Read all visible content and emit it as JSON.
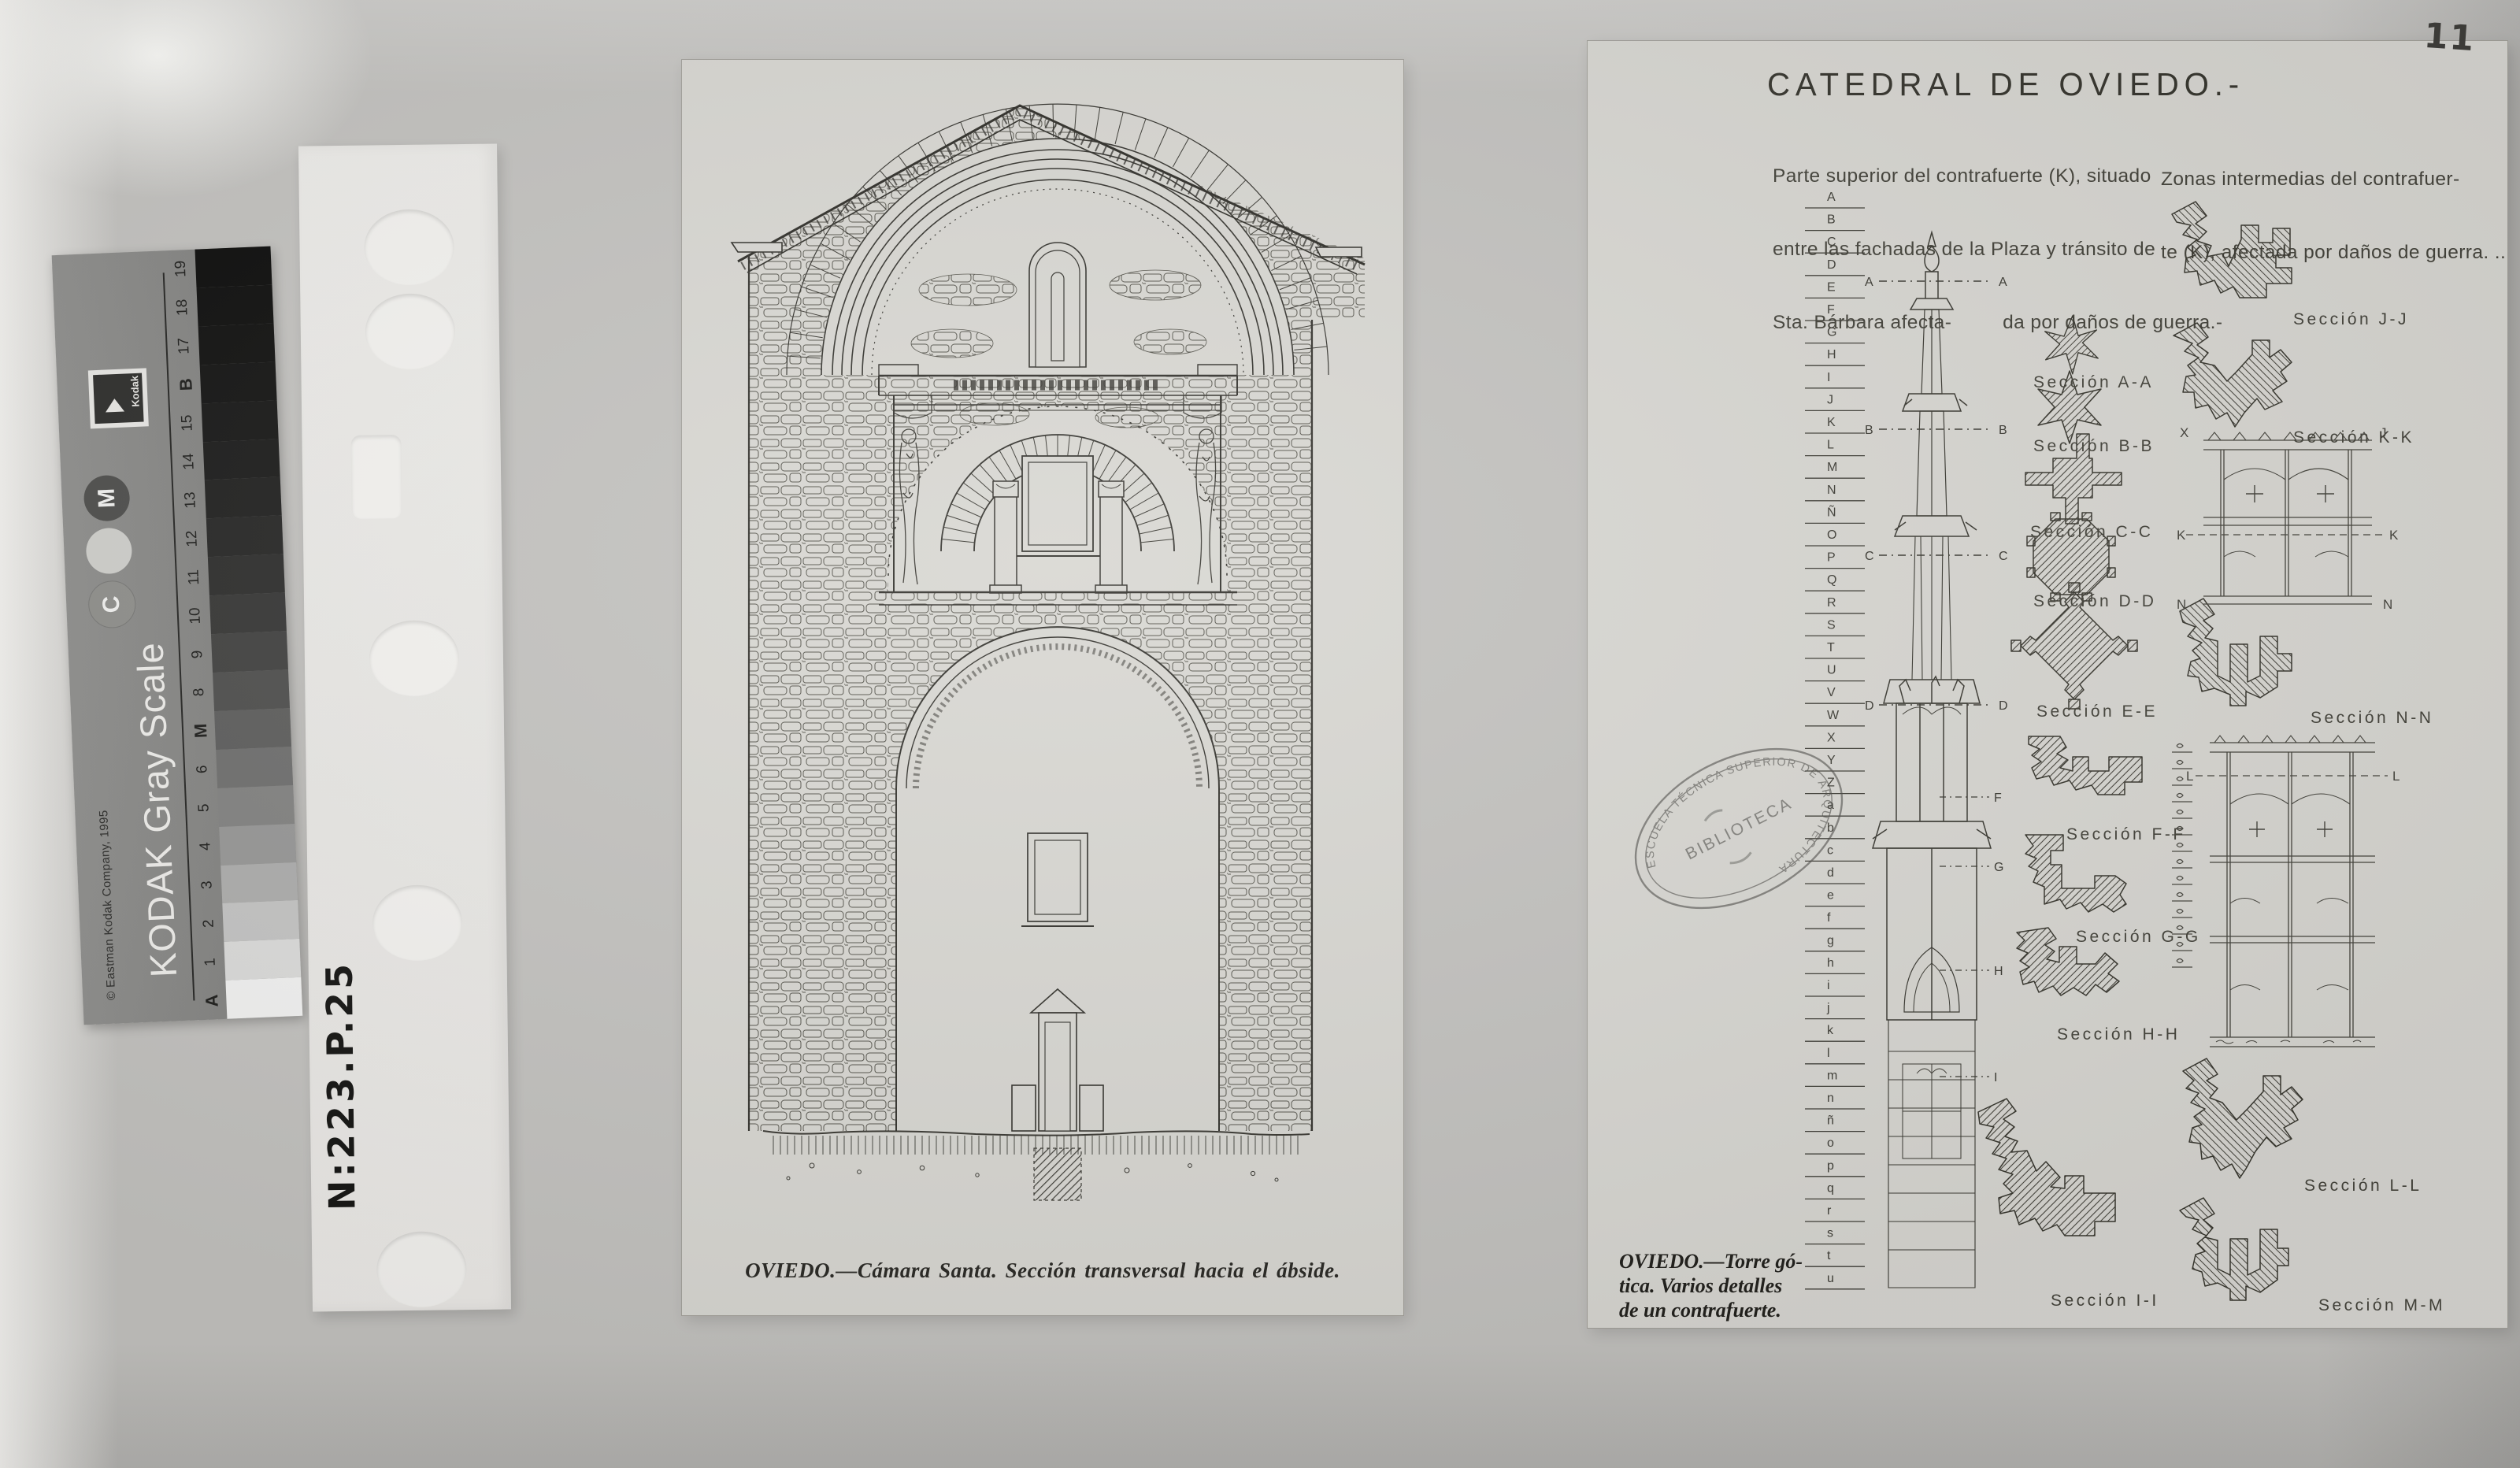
{
  "photo": {
    "page_number": "11",
    "handwritten_code": "N:223.P.25"
  },
  "kodak_card": {
    "brand": "Kodak",
    "title": "KODAK Gray Scale",
    "copyright": "© Eastman Kodak Company, 1995",
    "circle_labels_top_to_bottom": [
      "M",
      "C"
    ],
    "steps_top_to_bottom": [
      "19",
      "18",
      "17",
      "B",
      "15",
      "14",
      "13",
      "12",
      "11",
      "10",
      "9",
      "8",
      "M",
      "6",
      "5",
      "4",
      "3",
      "2",
      "1",
      "A"
    ]
  },
  "center_sheet": {
    "caption": "OVIEDO.—Cámara Santa. Sección transversal hacia el ábside."
  },
  "right_sheet": {
    "title": "CATEDRAL DE OVIEDO.-",
    "note_left_lines": [
      "Parte superior del contrafuerte (K), situado",
      "entre las fachadas de la Plaza y tránsito de",
      "Sta. Bárbara afecta-         da por daños de guerra.-"
    ],
    "note_right_lines": [
      "Zonas intermedias del contrafuer-",
      "te (K), afectada por daños de guerra. .."
    ],
    "caption_lines": [
      "OVIEDO.—Torre gó-",
      "tica. Varios detalles",
      "de un contrafuerte."
    ],
    "stamp": {
      "ring_text": "ESCUELA TÉCNICA SUPERIOR DE ARQUITECTURA",
      "center_text": "BIBLIOTECA"
    },
    "tower_scale_letters": [
      "A",
      "B",
      "C",
      "D",
      "E",
      "F",
      "G",
      "H",
      "I",
      "J",
      "K",
      "L",
      "M",
      "N",
      "Ñ",
      "O",
      "P",
      "Q",
      "R",
      "S",
      "T",
      "U",
      "V",
      "W",
      "X",
      "Y",
      "Z",
      "a",
      "b",
      "c",
      "d",
      "e",
      "f",
      "g",
      "h",
      "i",
      "j",
      "k",
      "l",
      "m",
      "n",
      "ñ",
      "o",
      "p",
      "q",
      "r",
      "s",
      "t",
      "u"
    ],
    "tower_cut_marks": [
      "A",
      "B",
      "C",
      "D"
    ],
    "tower_side_marks": [
      "F",
      "G",
      "H",
      "I"
    ],
    "elevation_marks": {
      "top_left": "X",
      "top_right": "J",
      "k": "K",
      "n": "N",
      "l": "L"
    },
    "sections_middle": [
      "Sección  A-A",
      "Sección  B-B",
      "Sección  C-C",
      "Sección  D-D",
      "Sección  E-E",
      "Sección  F-F",
      "Sección  G-G",
      "Sección  H-H",
      "Sección  I-I"
    ],
    "sections_right": [
      "Sección  J-J",
      "Sección  K-K",
      "Sección  N-N",
      "Sección  L-L",
      "Sección  M-M"
    ]
  }
}
